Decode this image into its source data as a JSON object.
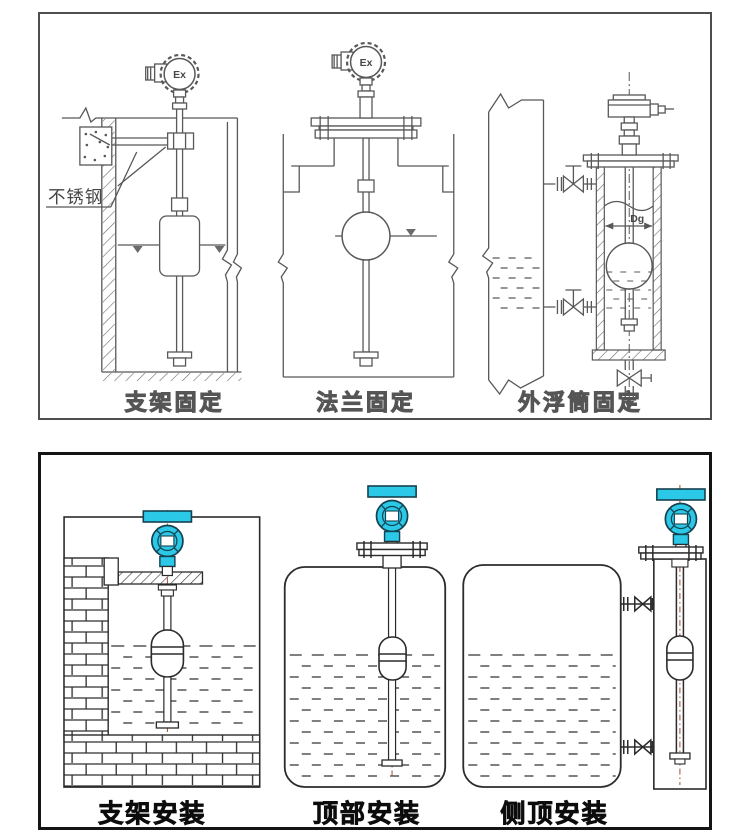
{
  "top_panel": {
    "figures": [
      {
        "label": "支架固定"
      },
      {
        "label": "法兰固定"
      },
      {
        "label": "外浮筒固定"
      }
    ],
    "stainless_steel_note": "不锈钢",
    "ex_marking": "Ex",
    "diameter_label": "Dg"
  },
  "bottom_panel": {
    "figures": [
      {
        "label": "支架安装"
      },
      {
        "label": "顶部安装"
      },
      {
        "label": "侧顶安装"
      }
    ]
  },
  "colors": {
    "transmitter_head": "#2bc8e8",
    "transmitter_outline": "#15424f",
    "top_line": "#585858",
    "bottom_line": "#2b2b2b",
    "axis_red": "#a04a38"
  }
}
